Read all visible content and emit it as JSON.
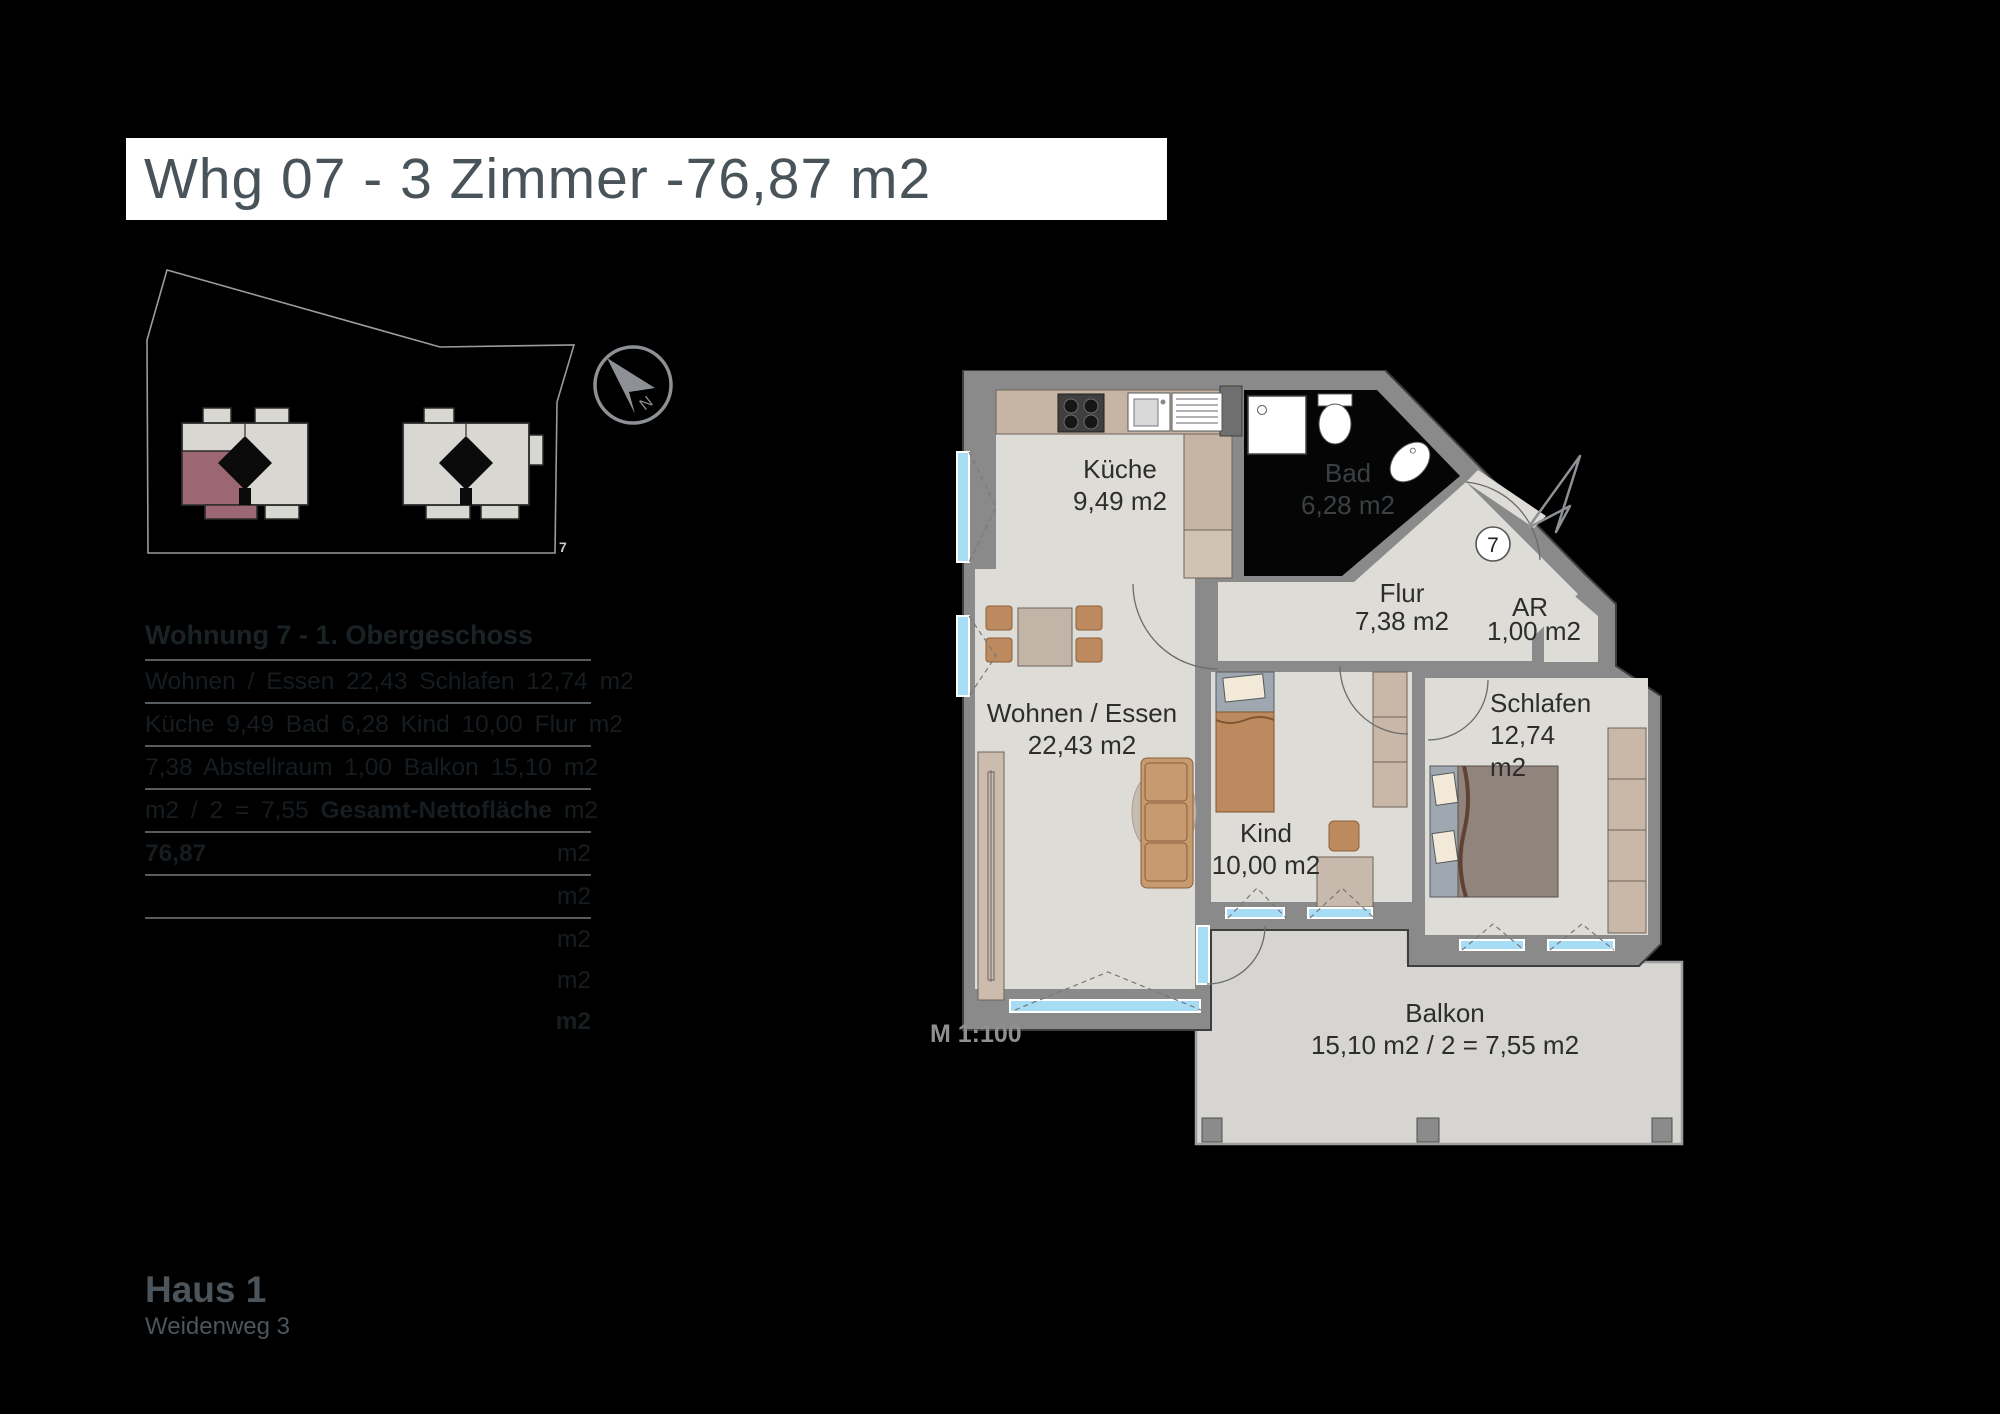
{
  "title": "Whg 07 - 3 Zimmer -76,87 m2",
  "site_plan": {
    "plot_number": "7"
  },
  "compass": {
    "north_label": "N"
  },
  "table": {
    "header": "Wohnung 7 - 1. Obergeschoss",
    "rows": [
      {
        "text": "Wohnen / Essen 22,43 Schlafen 12,74",
        "bold": "",
        "unit": "m2"
      },
      {
        "text": "Küche 9,49 Bad 6,28 Kind 10,00 Flur",
        "bold": "",
        "unit": "m2"
      },
      {
        "text": "7,38 Abstellraum 1,00 Balkon 15,10",
        "bold": "",
        "unit": "m2"
      },
      {
        "text": "m2 / 2 = 7,55 ",
        "bold": "Gesamt-Nettofläche",
        "unit": "m2"
      },
      {
        "text": "",
        "bold": "76,87",
        "unit": "m2"
      },
      {
        "text": "",
        "bold": "",
        "unit": "m2"
      },
      {
        "text": "",
        "bold": "",
        "unit": "m2"
      },
      {
        "text": "",
        "bold": "",
        "unit": "m2"
      },
      {
        "text": "",
        "bold": "",
        "unit": "m2"
      }
    ]
  },
  "floor_plan": {
    "scale": "M 1:100",
    "unit_circle": "7",
    "rooms": {
      "kueche": {
        "name": "Küche",
        "area": "9,49 m2"
      },
      "bad": {
        "name": "Bad",
        "area": "6,28 m2"
      },
      "flur": {
        "name": "Flur",
        "area": "7,38 m2"
      },
      "ar": {
        "name": "AR",
        "area": "1,00 m2"
      },
      "schlafen": {
        "name": "Schlafen",
        "area": "12,74",
        "area2": "m2"
      },
      "kind": {
        "name": "Kind",
        "area": "10,00 m2"
      },
      "wohnen": {
        "name": "Wohnen / Essen",
        "area": "22,43 m2"
      },
      "balkon": {
        "name": "Balkon",
        "area": "15,10 m2 / 2 = 7,55 m2"
      }
    }
  },
  "footer": {
    "house": "Haus 1",
    "street": "Weidenweg 3"
  },
  "colors": {
    "highlight_apartment": "#9c6672",
    "wall": "#8a8a8a",
    "floor": "#dedcd7",
    "window": "#a6dcf4",
    "title_text": "#49545a",
    "bad_label": "#3a4043"
  }
}
